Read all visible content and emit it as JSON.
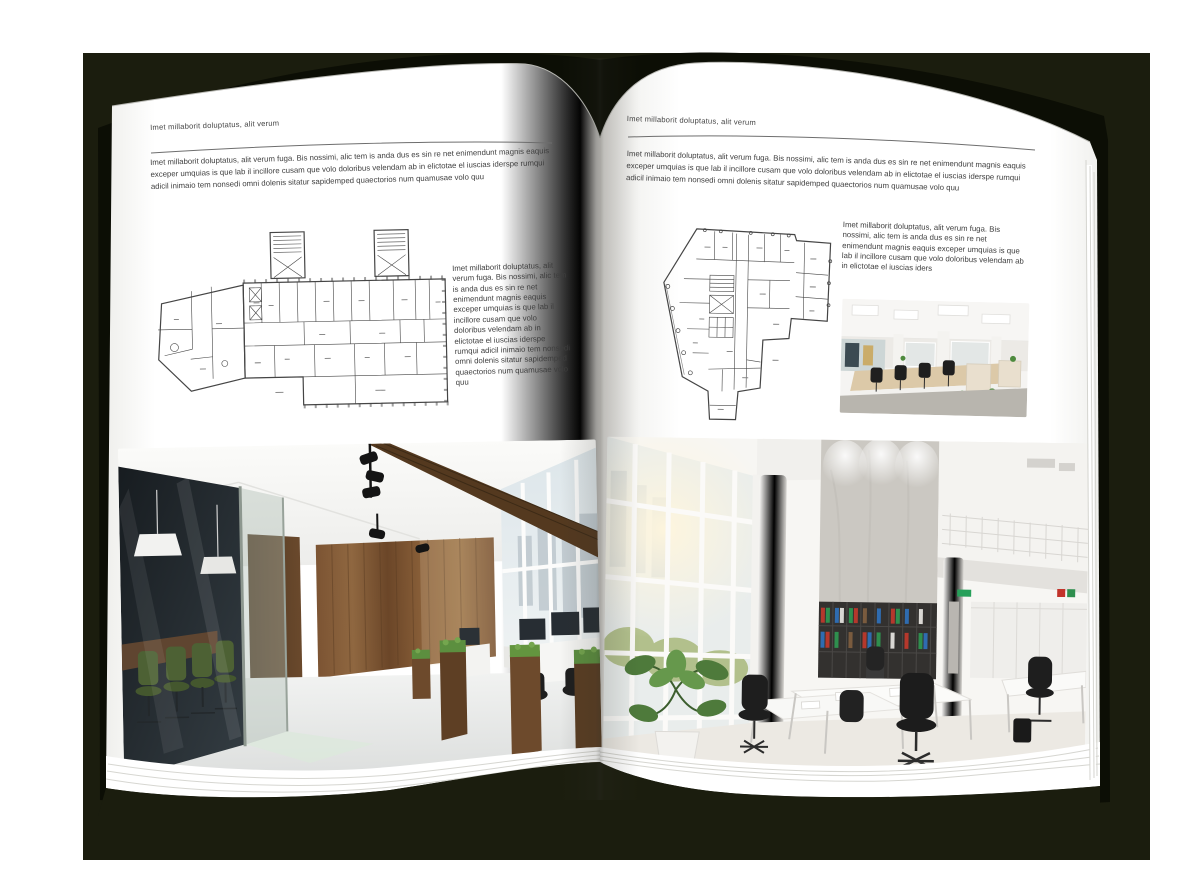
{
  "colors": {
    "backdrop": "#1b1d0e",
    "page": "#ffffff",
    "text": "#3e3e3e",
    "rule": "#6e6e6e"
  },
  "book": {
    "left_page": {
      "header": "Imet millaborit doluptatus, alit verum",
      "body": "Imet millaborit doluptatus, alit verum fuga. Bis nossimi, alic tem is anda dus es sin re net enimendunt magnis eaquis exceper umquias is que lab il incillore cusam que volo doloribus velendam ab in elictotae el iuscias iderspe rumqui adicil inimaio tem nonsedi omni dolenis sitatur sapidemped quaectorios num quamusae volo quu",
      "side_text": "Imet millaborit doluptatus, alit verum fuga. Bis nossimi, alic tem is anda dus es sin re net enimendunt magnis eaquis exceper umquias is que lab il incillore cusam que volo doloribus velendam ab in elictotae el iuscias iderspe rumqui adicil inimaio tem nonsedi omni dolenis sitatur sapidemped quaectorios num quamusae volo quu"
    },
    "right_page": {
      "header": "Imet millaborit doluptatus, alit verum",
      "body": "Imet millaborit doluptatus, alit verum fuga. Bis nossimi, alic tem is anda dus es sin re net enimendunt magnis eaquis exceper umquias is que lab il incillore cusam que volo doloribus velendam ab in elictotae el iuscias iderspe rumqui adicil inimaio tem nonsedi omni dolenis sitatur sapidemped quaectorios num quamusae volo quu",
      "side_text": "Imet millaborit doluptatus, alit verum fuga. Bis nossimi, alic tem is anda dus es sin re net enimendunt magnis eaquis exceper umquias is que lab il incillore cusam que volo doloribus velendam ab in elictotae el iuscias iders"
    }
  }
}
